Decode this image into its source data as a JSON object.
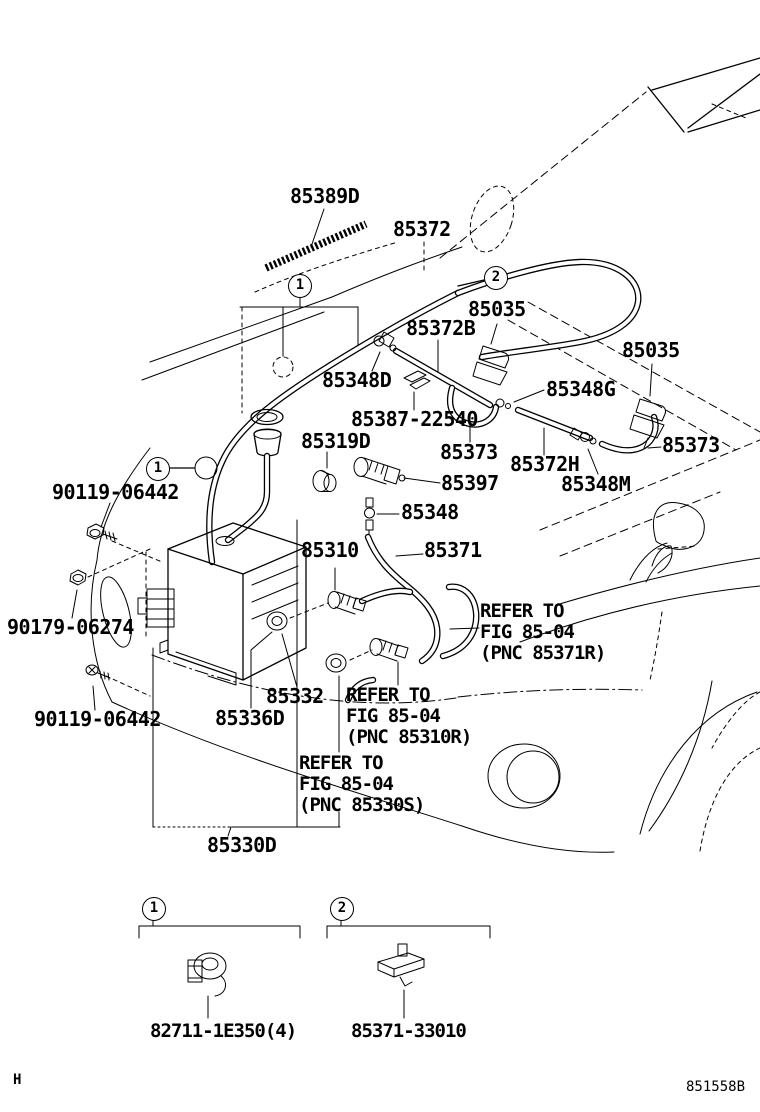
{
  "page": {
    "footer_left": "H",
    "drawing_code": "851558B"
  },
  "callouts": {
    "one": "1",
    "two": "2"
  },
  "parts": {
    "p85389d": "85389D",
    "p85372": "85372",
    "p85035_left": "85035",
    "p85372b": "85372B",
    "p85348d": "85348D",
    "p85035_right": "85035",
    "p85348g": "85348G",
    "p85387_22540": "85387-22540",
    "p85319d": "85319D",
    "p85373_left": "85373",
    "p85372h": "85372H",
    "p85373_right": "85373",
    "p85397": "85397",
    "p85348m": "85348M",
    "p85348": "85348",
    "p90119_06442_upper": "90119-06442",
    "p85310": "85310",
    "p85371": "85371",
    "p90179_06274": "90179-06274",
    "p85332": "85332",
    "p85336d": "85336D",
    "p90119_06442_lower": "90119-06442",
    "p85330d": "85330D",
    "legend1_part": "82711-1E350(4)",
    "legend2_part": "85371-33010"
  },
  "refer_blocks": {
    "r85371r": {
      "line1": "REFER TO",
      "line2": "FIG 85-04",
      "line3": "(PNC 85371R)"
    },
    "r85310r": {
      "line1": "REFER TO",
      "line2": "FIG 85-04",
      "line3": "(PNC 85310R)"
    },
    "r85330s": {
      "line1": "REFER TO",
      "line2": "FIG 85-04",
      "line3": "(PNC 85330S)"
    }
  }
}
